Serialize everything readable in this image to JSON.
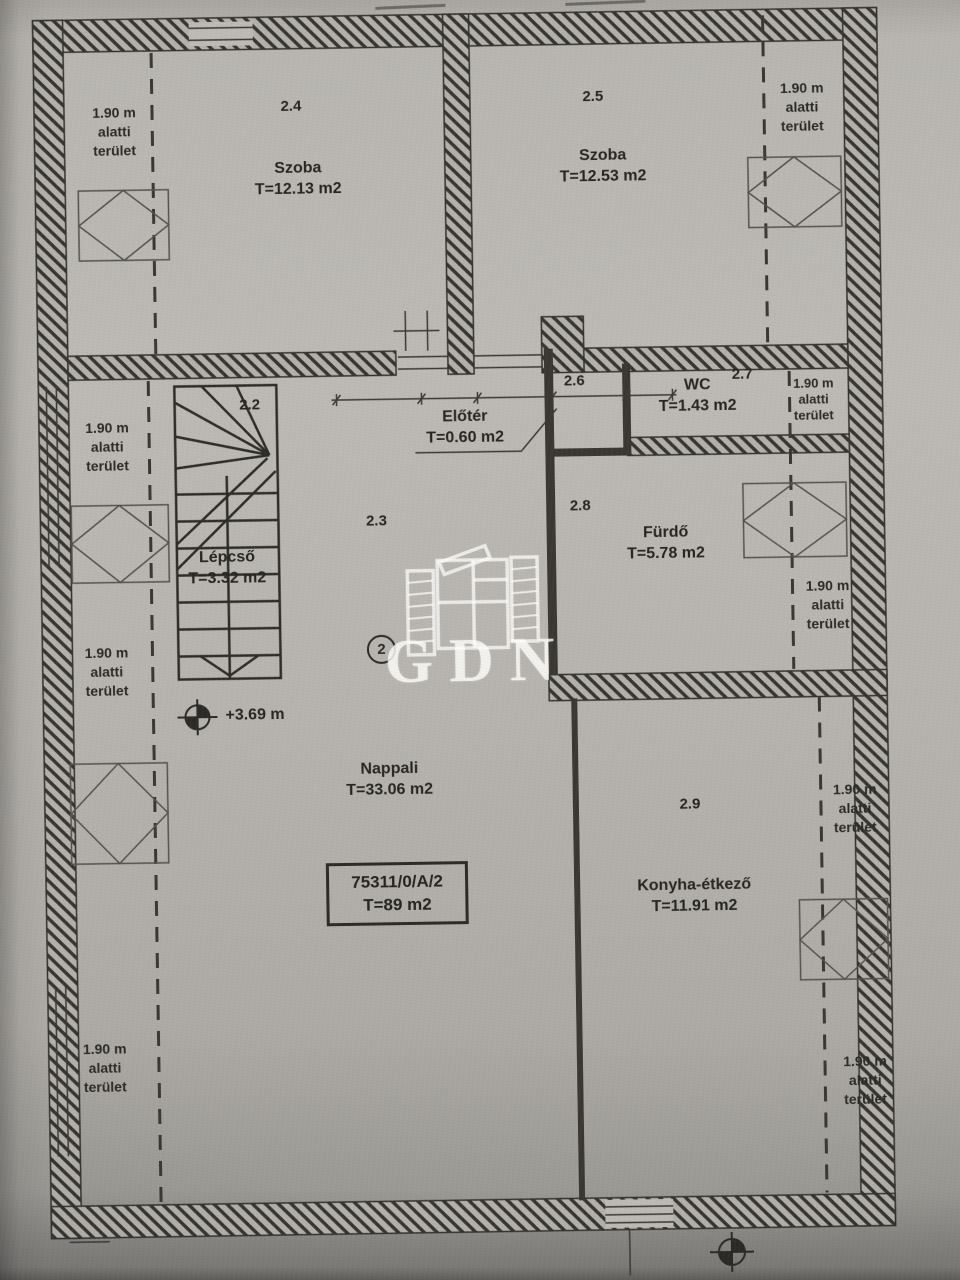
{
  "palette": {
    "paper": "#b6b3ae",
    "ink": "#2e2c29",
    "watermark": "#fcfcf9"
  },
  "watermark": {
    "text": "GDN"
  },
  "plan": {
    "sheet_circle": "2",
    "level_mark": "+3.69 m",
    "unit_box": {
      "lot": "75311/0/A/2",
      "area": "T=89 m2"
    },
    "low_area_note": {
      "l1": "1.90 m",
      "l2": "alatti",
      "l3": "terület"
    },
    "rooms": [
      {
        "number": "2.2",
        "name": "Lépcső",
        "area": "T=3.32 m2"
      },
      {
        "number": "2.3",
        "name": "Nappali",
        "area": "T=33.06 m2"
      },
      {
        "number": "2.4",
        "name": "Szoba",
        "area": "T=12.13 m2"
      },
      {
        "number": "2.5",
        "name": "Szoba",
        "area": "T=12.53 m2"
      },
      {
        "number": "2.6",
        "name": "Előtér",
        "area": "T=0.60 m2"
      },
      {
        "number": "2.7",
        "name": "WC",
        "area": "T=1.43 m2"
      },
      {
        "number": "2.8",
        "name": "Fürdő",
        "area": "T=5.78 m2"
      },
      {
        "number": "2.9",
        "name": "Konyha-étkező",
        "area": "T=11.91 m2"
      }
    ]
  }
}
